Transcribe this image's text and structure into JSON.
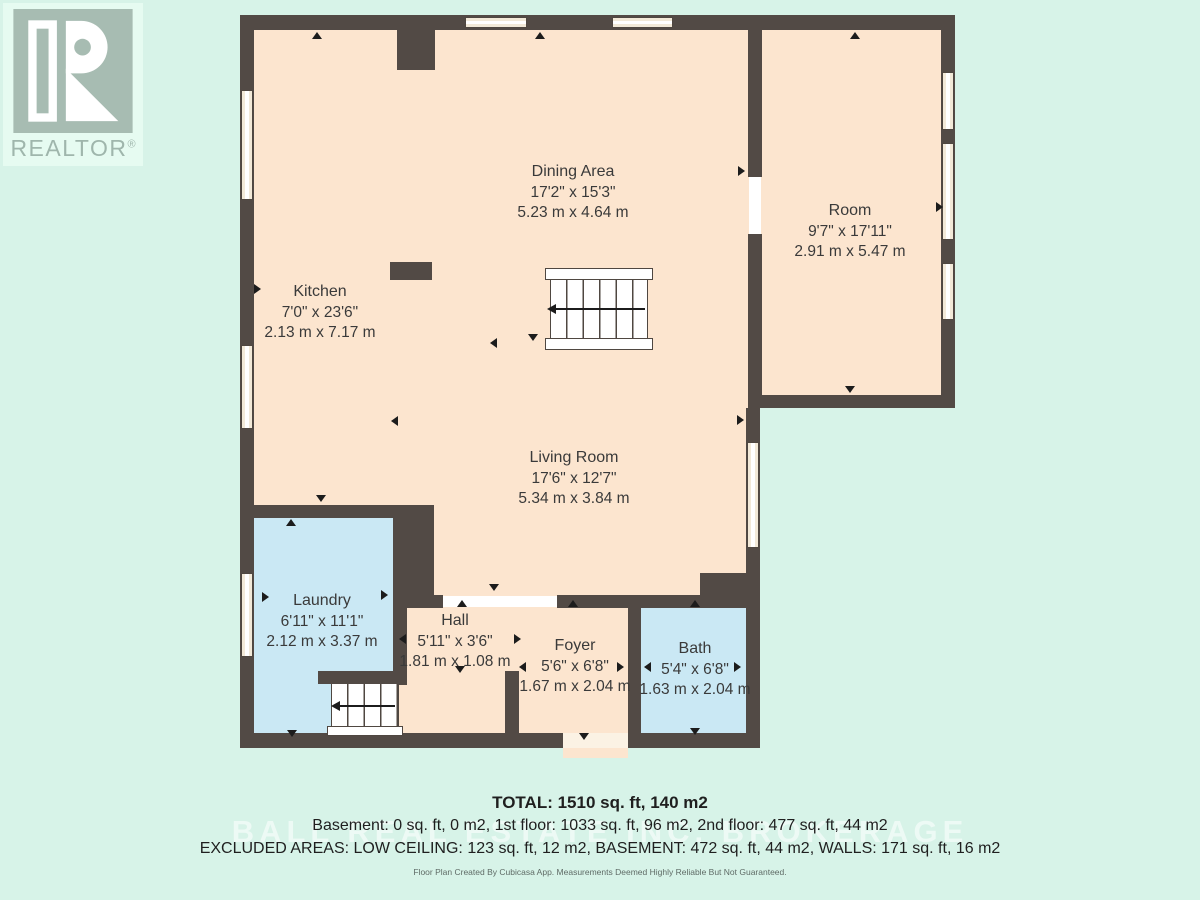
{
  "branding": {
    "logo_text": "REALTOR",
    "reg": "®"
  },
  "rooms": [
    {
      "name": "Dining Area",
      "imperial": "17'2\" x 15'3\"",
      "metric": "5.23 m x 4.64 m"
    },
    {
      "name": "Room",
      "imperial": "9'7\" x 17'11\"",
      "metric": "2.91 m x 5.47 m"
    },
    {
      "name": "Kitchen",
      "imperial": "7'0\" x 23'6\"",
      "metric": "2.13 m x 7.17 m"
    },
    {
      "name": "Living Room",
      "imperial": "17'6\" x 12'7\"",
      "metric": "5.34 m x 3.84 m"
    },
    {
      "name": "Laundry",
      "imperial": "6'11\" x 11'1\"",
      "metric": "2.12 m x 3.37 m"
    },
    {
      "name": "Hall",
      "imperial": "5'11\" x 3'6\"",
      "metric": "1.81 m x 1.08 m"
    },
    {
      "name": "Foyer",
      "imperial": "5'6\" x 6'8\"",
      "metric": "1.67 m x 2.04 m"
    },
    {
      "name": "Bath",
      "imperial": "5'4\" x 6'8\"",
      "metric": "1.63 m x 2.04 m"
    }
  ],
  "summary": {
    "total": "TOTAL: 1510 sq. ft, 140 m2",
    "floors": "Basement: 0 sq. ft, 0 m2, 1st floor: 1033 sq. ft, 96 m2, 2nd floor: 477 sq. ft, 44 m2",
    "excluded": "EXCLUDED AREAS: LOW CEILING: 123 sq. ft, 12 m2, BASEMENT: 472 sq. ft, 44 m2, WALLS: 171 sq. ft, 16 m2"
  },
  "watermark": "BALL REAL ESTATE INC. BROKERAGE",
  "footer": "Floor Plan Created By Cubicasa App. Measurements Deemed Highly Reliable But Not Guaranteed.",
  "colors": {
    "background": "#d7f3e8",
    "floor": "#fce5cf",
    "wet_floor": "#cae8f4",
    "wall": "#524a45",
    "window": "#f2e9d8",
    "logo": "#a7bcb2"
  }
}
